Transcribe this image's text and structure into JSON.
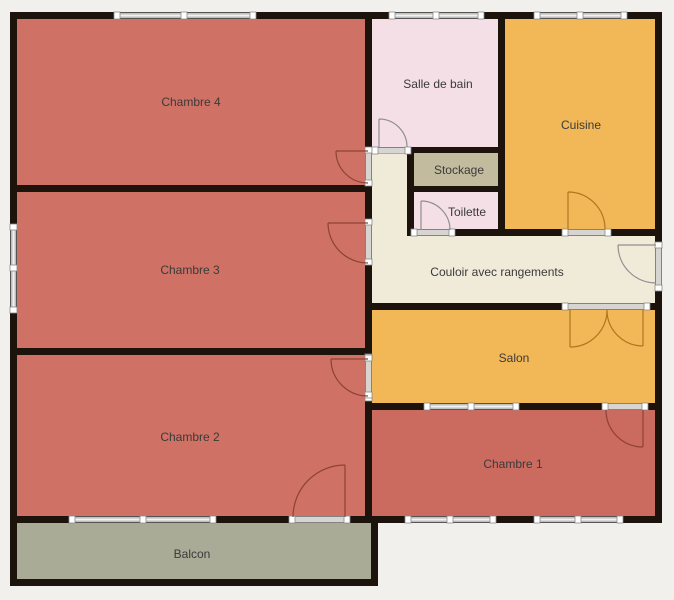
{
  "plan": {
    "colors": {
      "background": "#f2f0ed",
      "wall": "#1c130d",
      "win_band": "#c8c8c8",
      "win_glass": "#f2f2f2",
      "threshold": "#d7d5d1",
      "cap": "#ffffff",
      "win_edge": "#8a8a8a",
      "door_red": "#8e4234",
      "door_orange": "#b0751f",
      "door_grey": "#8f8f8f",
      "label": "#3a3a3a"
    }
  },
  "rooms": [
    {
      "id": "chambre-4",
      "label": "Chambre 4",
      "color": "#cf7265"
    },
    {
      "id": "chambre-3",
      "label": "Chambre 3",
      "color": "#cf7265"
    },
    {
      "id": "chambre-2",
      "label": "Chambre 2",
      "color": "#cf7265"
    },
    {
      "id": "balcon",
      "label": "Balcon",
      "color": "#a9ab96"
    },
    {
      "id": "salle-de-bain",
      "label": "Salle de bain",
      "color": "#f4dfe7"
    },
    {
      "id": "stockage",
      "label": "Stockage",
      "color": "#c3bb9e"
    },
    {
      "id": "toilette",
      "label": "Toilette",
      "color": "#f4dfe7"
    },
    {
      "id": "cuisine",
      "label": "Cuisine",
      "color": "#f2b857"
    },
    {
      "id": "couloir",
      "label": "Couloir avec rangements",
      "color": "#f0ead9"
    },
    {
      "id": "salon",
      "label": "Salon",
      "color": "#f2b857"
    },
    {
      "id": "chambre-1",
      "label": "Chambre 1",
      "color": "#cb6a5e"
    }
  ]
}
